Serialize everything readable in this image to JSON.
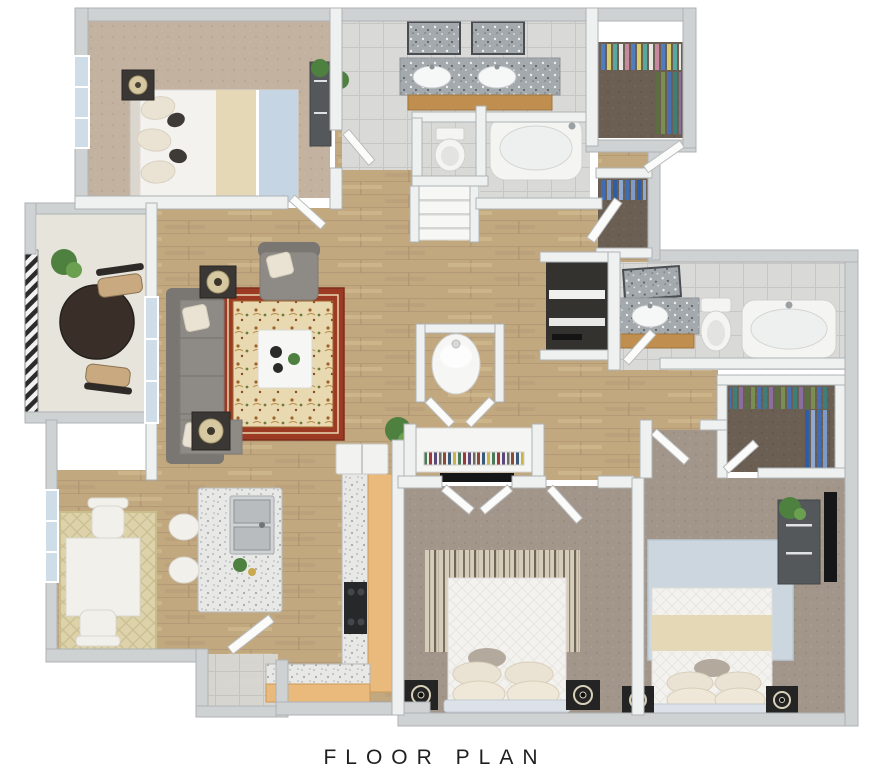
{
  "title": "FLOOR PLAN",
  "palette": {
    "page_bg": "#ffffff",
    "title_color": "#1f1f1f",
    "wall_face": "#eff1f1",
    "wall_stroke": "#aeb2b4",
    "wall_outer": "#ced2d3",
    "hardwood": "#c1a87f",
    "hardwood_line": "#a98e6e",
    "tile": "#d9dad8",
    "tile_line": "#c6c7c5",
    "carpet_tan": "#c4b2a0",
    "carpet_taupe": "#a2958a",
    "carpet_dark": "#6b5f54",
    "balcony_floor": "#e7e4dc",
    "rug_border": "#9c3a23",
    "rug_field": "#e8d9b0",
    "rug_dining": "#ddd2a9",
    "rug_blue": "#ccd6df",
    "rug_runner": "#d6ccba",
    "sofa": "#8e8a86",
    "sofa_dark": "#7a7672",
    "pillow": "#eae3d4",
    "table_white": "#f6f6f4",
    "end_table": "#3b3734",
    "lamp": "#d6c9a2",
    "patio_table": "#3a2f28",
    "chair_tan": "#c9a97f",
    "granite_dark": "#a4a9ad",
    "granite_light": "#e8e8e6",
    "wood_cabinet": "#eab97c",
    "wood_vanity": "#c08f4f",
    "stainless": "#b9bcbe",
    "appliance_dark": "#26282a",
    "fixture_white": "#f4f4f2",
    "door_white": "#fbfbfa",
    "glass_blue": "#cfdde8",
    "water_blue": "#c6d5e3",
    "blanket_cream": "#e5d8b7",
    "bed_frame_blue": "#dde2e8",
    "speaker_black": "#242424",
    "dresser_gray": "#54585a",
    "tv_black": "#151617",
    "plant_green": "#4e8040",
    "plant_dark": "#2f5426",
    "laundry_dark": "#34322f",
    "clothes_blue": "#4f7dc0",
    "clothes_yellow": "#d8cc71",
    "clothes_teal": "#58a8a0",
    "clothes_pink": "#c789a0",
    "clothes_olive": "#7b8e52",
    "clothes_purple": "#8a6f9e"
  }
}
